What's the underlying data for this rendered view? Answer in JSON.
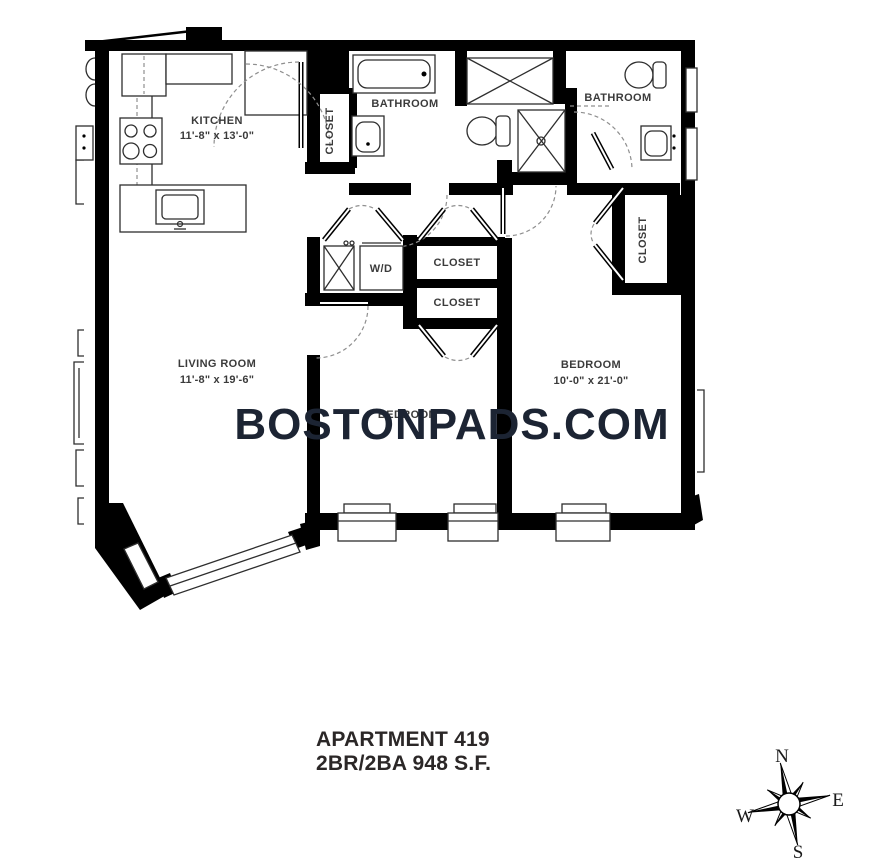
{
  "watermark": "BOSTONPADS.COM",
  "title": {
    "line1": "APARTMENT 419",
    "line2": "2BR/2BA 948 S.F."
  },
  "rooms": {
    "kitchen": {
      "name": "KITCHEN",
      "dims": "11'-8\" x 13'-0\""
    },
    "living_room": {
      "name": "LIVING ROOM",
      "dims": "11'-8\" x 19'-6\""
    },
    "bedroom_1": {
      "name": "BEDROOM"
    },
    "bedroom_2": {
      "name": "BEDROOM",
      "dims": "10'-0\" x 21'-0\""
    },
    "bathroom_1": {
      "name": "BATHROOM"
    },
    "bathroom_2": {
      "name": "BATHROOM"
    },
    "closet_entry": {
      "name": "CLOSET"
    },
    "closet_right": {
      "name": "CLOSET"
    },
    "closet_1": {
      "name": "CLOSET"
    },
    "closet_2": {
      "name": "CLOSET"
    },
    "laundry": {
      "name": "W/D"
    }
  },
  "compass": {
    "n": "N",
    "e": "E",
    "s": "S",
    "w": "W"
  },
  "colors": {
    "wall": "#000000",
    "line": "#2e2e2e",
    "label": "#3b3b3b",
    "watermark": "#1c2433",
    "title": "#2b2727"
  }
}
